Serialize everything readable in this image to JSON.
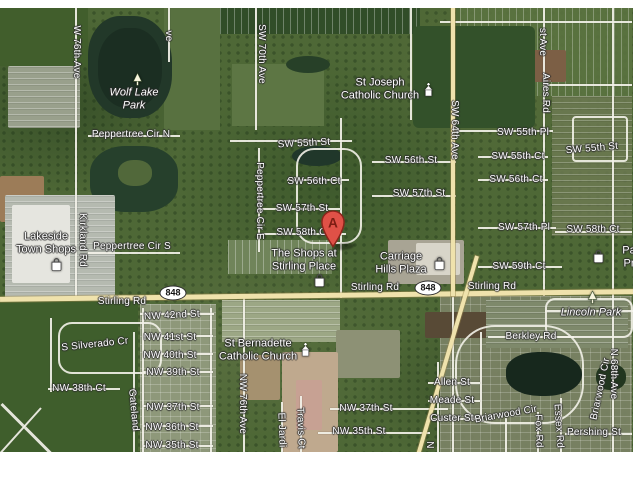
{
  "map_type": "satellite",
  "marker": {
    "letter": "A"
  },
  "shields": [
    {
      "route": "848",
      "x": 173,
      "y": 285
    },
    {
      "route": "848",
      "x": 428,
      "y": 280
    }
  ],
  "streets": [
    {
      "text": "W 76th Ave",
      "x": 76,
      "y": 44,
      "r": 90
    },
    {
      "text": "ve",
      "x": 168,
      "y": 28,
      "r": 90
    },
    {
      "text": "SW 70th Ave",
      "x": 261,
      "y": 46,
      "r": 90
    },
    {
      "text": "st Ave",
      "x": 542,
      "y": 34,
      "r": 90
    },
    {
      "text": "Aires Rd",
      "x": 545,
      "y": 85,
      "r": 90
    },
    {
      "text": "SW 64th Ave",
      "x": 454,
      "y": 122,
      "r": 90
    },
    {
      "text": "Peppertree Cir N",
      "x": 131,
      "y": 127,
      "r": 0
    },
    {
      "text": "SW 55th St",
      "x": 304,
      "y": 136,
      "r": -3
    },
    {
      "text": "SW 56th Ct",
      "x": 314,
      "y": 174,
      "r": 0
    },
    {
      "text": "SW 57th St",
      "x": 302,
      "y": 201,
      "r": 0
    },
    {
      "text": "SW 58th Ct",
      "x": 303,
      "y": 225,
      "r": 0
    },
    {
      "text": "Peppertree Cir E",
      "x": 259,
      "y": 193,
      "r": 90
    },
    {
      "text": "Kirkland Rd",
      "x": 82,
      "y": 232,
      "r": 90
    },
    {
      "text": "Peppertree Cir S",
      "x": 132,
      "y": 239,
      "r": 0
    },
    {
      "text": "SW 56th St",
      "x": 411,
      "y": 153,
      "r": 0
    },
    {
      "text": "SW 57th St",
      "x": 419,
      "y": 186,
      "r": 0
    },
    {
      "text": "SW 55th Pl",
      "x": 523,
      "y": 125,
      "r": 0
    },
    {
      "text": "SW 55th Ct",
      "x": 518,
      "y": 149,
      "r": 0
    },
    {
      "text": "SW 56th Ct",
      "x": 516,
      "y": 172,
      "r": 0
    },
    {
      "text": "SW 57th Pl",
      "x": 524,
      "y": 220,
      "r": 0
    },
    {
      "text": "SW 55th St",
      "x": 592,
      "y": 141,
      "r": -5
    },
    {
      "text": "SW 58th Ct",
      "x": 593,
      "y": 222,
      "r": 0
    },
    {
      "text": "SW 59th Ct",
      "x": 519,
      "y": 259,
      "r": 0
    },
    {
      "text": "Stirling Rd",
      "x": 122,
      "y": 294,
      "r": 0
    },
    {
      "text": "Stirling Rd",
      "x": 375,
      "y": 280,
      "r": 0
    },
    {
      "text": "Stirling Rd",
      "x": 492,
      "y": 279,
      "r": 0
    },
    {
      "text": "NW 42nd St",
      "x": 172,
      "y": 308,
      "r": -3
    },
    {
      "text": "NW 41st St",
      "x": 170,
      "y": 330,
      "r": 0
    },
    {
      "text": "NW 40th St",
      "x": 170,
      "y": 348,
      "r": 0
    },
    {
      "text": "NW 39th St",
      "x": 173,
      "y": 365,
      "r": 0
    },
    {
      "text": "NW 38th Ct",
      "x": 79,
      "y": 381,
      "r": 0
    },
    {
      "text": "NW 37th St",
      "x": 173,
      "y": 400,
      "r": 0
    },
    {
      "text": "NW 36th St",
      "x": 172,
      "y": 420,
      "r": 0
    },
    {
      "text": "NW 35th St",
      "x": 172,
      "y": 438,
      "r": 0
    },
    {
      "text": "S Silverado Cr",
      "x": 95,
      "y": 337,
      "r": -6
    },
    {
      "text": "Gateland",
      "x": 133,
      "y": 402,
      "r": 85
    },
    {
      "text": "NW 76th Ave",
      "x": 242,
      "y": 396,
      "r": 90
    },
    {
      "text": "El Jardi",
      "x": 281,
      "y": 422,
      "r": 88
    },
    {
      "text": "Travis Ct",
      "x": 300,
      "y": 420,
      "r": 88
    },
    {
      "text": "NW 37th St",
      "x": 366,
      "y": 401,
      "r": 0
    },
    {
      "text": "NW 35th St",
      "x": 359,
      "y": 424,
      "r": 0
    },
    {
      "text": "Allen St",
      "x": 452,
      "y": 375,
      "r": 0
    },
    {
      "text": "Meade St",
      "x": 452,
      "y": 393,
      "r": 0
    },
    {
      "text": "Custer St",
      "x": 452,
      "y": 411,
      "r": 0
    },
    {
      "text": "N",
      "x": 429,
      "y": 437,
      "r": 90
    },
    {
      "text": "Berkley Rd",
      "x": 531,
      "y": 329,
      "r": 0
    },
    {
      "text": "N 68th Ave",
      "x": 613,
      "y": 366,
      "r": 90
    },
    {
      "text": "Briarwood Cir",
      "x": 506,
      "y": 407,
      "r": -10
    },
    {
      "text": "Briarwood Cir",
      "x": 601,
      "y": 381,
      "r": -78
    },
    {
      "text": "Fox Rd",
      "x": 538,
      "y": 423,
      "r": 88
    },
    {
      "text": "Essex Rd",
      "x": 558,
      "y": 418,
      "r": 86
    },
    {
      "text": "Pershing St",
      "x": 594,
      "y": 425,
      "r": 0
    }
  ],
  "pois": [
    {
      "lines": [
        "Wolf Lake",
        "Park"
      ],
      "icon": "tree",
      "style": "park",
      "tx": 134,
      "ty": 91,
      "ix": 137,
      "iy": 71
    },
    {
      "lines": [
        "St Joseph",
        "Catholic Church"
      ],
      "icon": "church",
      "style": "",
      "tx": 380,
      "ty": 81,
      "ix": 428,
      "iy": 81
    },
    {
      "lines": [
        "Lakeside",
        "Town Shops"
      ],
      "icon": "bag",
      "style": "",
      "tx": 46,
      "ty": 235,
      "ix": 56,
      "iy": 256
    },
    {
      "lines": [
        "The Shops at",
        "Stirling Place"
      ],
      "icon": "bag",
      "style": "",
      "tx": 304,
      "ty": 252,
      "ix": 319,
      "iy": 272
    },
    {
      "lines": [
        "Carriage",
        "Hills Plaza"
      ],
      "icon": "bag",
      "style": "",
      "tx": 401,
      "ty": 255,
      "ix": 439,
      "iy": 255
    },
    {
      "lines": [
        "Lincoln Park"
      ],
      "icon": "tree",
      "style": "park",
      "tx": 591,
      "ty": 305,
      "ix": 592,
      "iy": 289
    },
    {
      "lines": [
        "St Bernadette",
        "Catholic Church"
      ],
      "icon": "church",
      "style": "",
      "tx": 258,
      "ty": 342,
      "ix": 305,
      "iy": 341
    },
    {
      "lines": [
        "Pa",
        "Pr"
      ],
      "icon": "bag",
      "style": "",
      "tx": 629,
      "ty": 249,
      "ix": 598,
      "iy": 248
    }
  ]
}
